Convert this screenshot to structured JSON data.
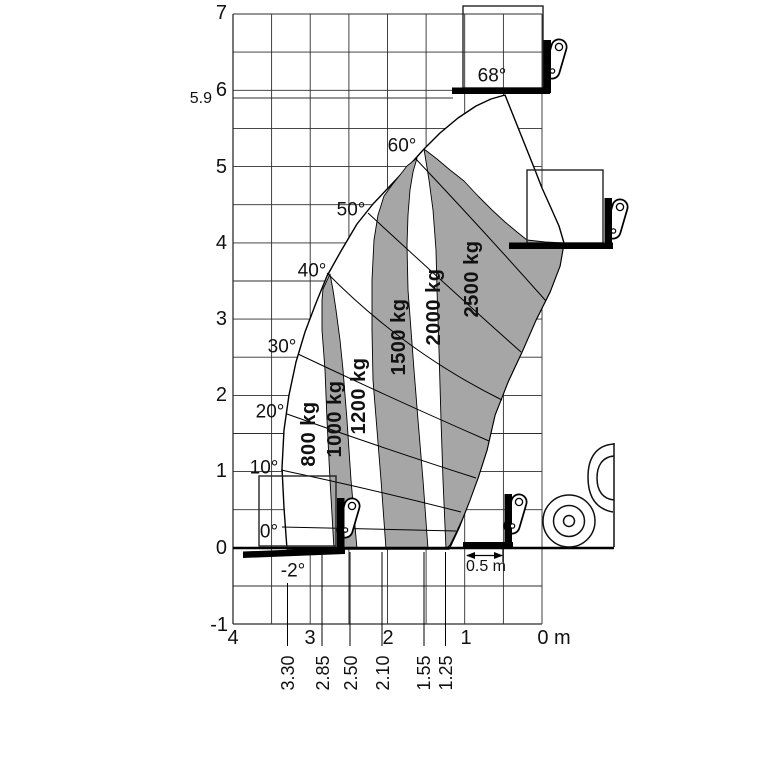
{
  "chart_data": {
    "type": "area",
    "description": "Telehandler lifting capacity / load envelope diagram: lift height (m) vs reach (m) with boom angle rays and alternating capacity zones",
    "x_axis": {
      "ticks": [
        "4",
        "3",
        "2",
        "1",
        "0 m"
      ],
      "unit": "m",
      "direction": "values decrease to the right"
    },
    "y_axis": {
      "ticks": [
        "-1",
        "0",
        "1",
        "2",
        "3",
        "4",
        "5",
        "6",
        "7"
      ],
      "unit": "m",
      "max_lift_height_marker": "5.9"
    },
    "reach_marks_m": [
      "3.30",
      "2.85",
      "2.50",
      "2.10",
      "1.55",
      "1.25"
    ],
    "boom_angles": [
      "-2°",
      "0°",
      "10°",
      "20°",
      "30°",
      "40°",
      "50°",
      "60°",
      "68°"
    ],
    "capacity_zones": [
      {
        "capacity": "800 kg",
        "shade": "white",
        "reach_at_ground_m": 3.3
      },
      {
        "capacity": "1000 kg",
        "shade": "gray",
        "reach_at_ground_m": 2.85
      },
      {
        "capacity": "1200 kg",
        "shade": "white",
        "reach_at_ground_m": 2.5
      },
      {
        "capacity": "1500 kg",
        "shade": "gray",
        "reach_at_ground_m": 2.1
      },
      {
        "capacity": "2000 kg",
        "shade": "white",
        "reach_at_ground_m": 1.55
      },
      {
        "capacity": "2500 kg",
        "shade": "gray",
        "reach_at_ground_m": 1.25
      }
    ],
    "fork_dimension_label": "0.5 m",
    "grid": "0.5 m squares",
    "legend_position": "none",
    "colors": {
      "zone_gray": "#a6a6a6",
      "line": "#000000",
      "background": "#ffffff"
    }
  },
  "labels": [
    {
      "n": "y-label-7",
      "t": "7",
      "x": 227,
      "y": 13,
      "c": "ax ar"
    },
    {
      "n": "y-label-6",
      "t": "6",
      "x": 227,
      "y": 90,
      "c": "ax ar"
    },
    {
      "n": "y-label-5-9",
      "t": "5.9",
      "x": 212,
      "y": 99,
      "c": "sm ar"
    },
    {
      "n": "y-label-5",
      "t": "5",
      "x": 227,
      "y": 167,
      "c": "ax ar"
    },
    {
      "n": "y-label-4",
      "t": "4",
      "x": 227,
      "y": 243,
      "c": "ax ar"
    },
    {
      "n": "y-label-3",
      "t": "3",
      "x": 227,
      "y": 319,
      "c": "ax ar"
    },
    {
      "n": "y-label-2",
      "t": "2",
      "x": 227,
      "y": 395,
      "c": "ax ar"
    },
    {
      "n": "y-label-1",
      "t": "1",
      "x": 227,
      "y": 471,
      "c": "ax ar"
    },
    {
      "n": "y-label-0",
      "t": "0",
      "x": 227,
      "y": 548,
      "c": "ax ar"
    },
    {
      "n": "y-label-neg1",
      "t": "-1",
      "x": 228,
      "y": 625,
      "c": "ax ar"
    },
    {
      "n": "x-label-4",
      "t": "4",
      "x": 233,
      "y": 638,
      "c": "ax"
    },
    {
      "n": "x-label-3",
      "t": "3",
      "x": 310,
      "y": 638,
      "c": "ax"
    },
    {
      "n": "x-label-2",
      "t": "2",
      "x": 388,
      "y": 638,
      "c": "ax"
    },
    {
      "n": "x-label-1",
      "t": "1",
      "x": 466,
      "y": 638,
      "c": "ax"
    },
    {
      "n": "x-label-0m",
      "t": "0 m",
      "x": 554,
      "y": 638,
      "c": "ax"
    },
    {
      "n": "angle-neg2",
      "t": "-2°",
      "x": 293,
      "y": 571,
      "c": "ang"
    },
    {
      "n": "angle-0",
      "t": "0°",
      "x": 269,
      "y": 532,
      "c": "ang"
    },
    {
      "n": "angle-10",
      "t": "10°",
      "x": 264,
      "y": 468,
      "c": "ang"
    },
    {
      "n": "angle-20",
      "t": "20°",
      "x": 270,
      "y": 412,
      "c": "ang"
    },
    {
      "n": "angle-30",
      "t": "30°",
      "x": 282,
      "y": 347,
      "c": "ang"
    },
    {
      "n": "angle-40",
      "t": "40°",
      "x": 312,
      "y": 271,
      "c": "ang"
    },
    {
      "n": "angle-50",
      "t": "50°",
      "x": 351,
      "y": 210,
      "c": "ang"
    },
    {
      "n": "angle-60",
      "t": "60°",
      "x": 402,
      "y": 146,
      "c": "ang"
    },
    {
      "n": "angle-68",
      "t": "68°",
      "x": 492,
      "y": 76,
      "c": "ang"
    },
    {
      "n": "zone-label-800",
      "t": "800 kg",
      "x": 309,
      "y": 434,
      "c": "load rot"
    },
    {
      "n": "zone-label-1000",
      "t": "1000 kg",
      "x": 335,
      "y": 419,
      "c": "load rot"
    },
    {
      "n": "zone-label-1200",
      "t": "1200 kg",
      "x": 359,
      "y": 396,
      "c": "load rot"
    },
    {
      "n": "zone-label-1500",
      "t": "1500 kg",
      "x": 399,
      "y": 337,
      "c": "load rot"
    },
    {
      "n": "zone-label-2000",
      "t": "2000 kg",
      "x": 434,
      "y": 307,
      "c": "load rot"
    },
    {
      "n": "zone-label-2500",
      "t": "2500 kg",
      "x": 472,
      "y": 279,
      "c": "load rot"
    },
    {
      "n": "reach-label-330",
      "t": "3.30",
      "x": 288,
      "y": 673,
      "c": "reach rot"
    },
    {
      "n": "reach-label-285",
      "t": "2.85",
      "x": 323,
      "y": 673,
      "c": "reach rot"
    },
    {
      "n": "reach-label-250",
      "t": "2.50",
      "x": 351,
      "y": 673,
      "c": "reach rot"
    },
    {
      "n": "reach-label-210",
      "t": "2.10",
      "x": 383,
      "y": 673,
      "c": "reach rot"
    },
    {
      "n": "reach-label-155",
      "t": "1.55",
      "x": 424,
      "y": 673,
      "c": "reach rot"
    },
    {
      "n": "reach-label-125",
      "t": "1.25",
      "x": 446,
      "y": 673,
      "c": "reach rot"
    },
    {
      "n": "fork-dim-label",
      "t": "0.5 m",
      "x": 486,
      "y": 567,
      "c": "dim"
    }
  ]
}
